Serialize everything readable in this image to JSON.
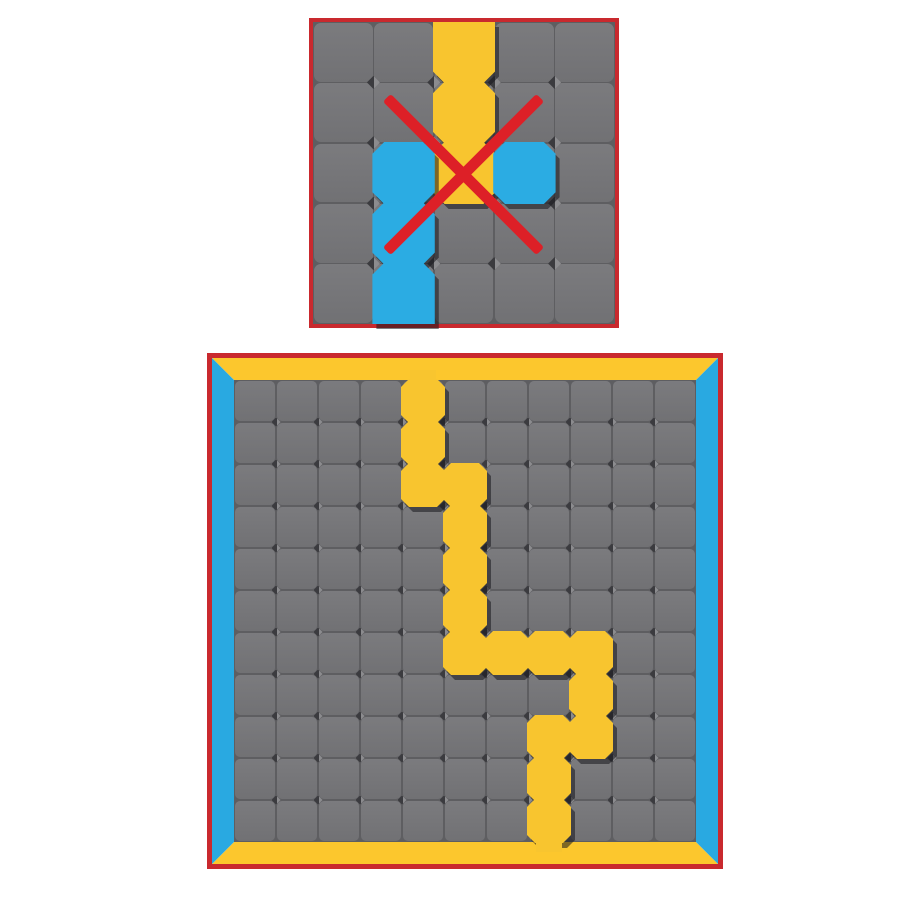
{
  "meta": {
    "width": 900,
    "height": 900,
    "background": "#ffffff"
  },
  "colors": {
    "board_border": "#C9292E",
    "cross": "#DD2027",
    "path_yellow": "#F8C52F",
    "path_blue": "#2BACE3",
    "frame_yellow": "#FCC72D",
    "frame_blue": "#29A9E1",
    "cell_fill_top": "#7B7B7E",
    "cell_fill_bottom": "#717174",
    "grid_line": "#5E5E61",
    "notch_dark": "#3B3B3F",
    "notch_light": "#8C8C8F",
    "shadow": "rgba(24,24,30,0.55)"
  },
  "tutorial_board": {
    "label": "invalid-move-example",
    "x": 309,
    "y": 18,
    "size": 310,
    "border": 4,
    "frame": 0,
    "cols": 5,
    "rows": 5,
    "interactable": false,
    "paths": [
      {
        "name": "yellow-path",
        "color_key": "path_yellow",
        "cells": [
          [
            2,
            0
          ],
          [
            2,
            1
          ],
          [
            2,
            2
          ]
        ],
        "flush": [
          {
            "col": 2,
            "row": 0,
            "side": "top"
          }
        ],
        "tabs": []
      },
      {
        "name": "blue-path",
        "color_key": "path_blue",
        "cells": [
          [
            1,
            2
          ],
          [
            3,
            2
          ],
          [
            1,
            3
          ],
          [
            1,
            4
          ]
        ],
        "flush": [
          {
            "col": 1,
            "row": 4,
            "side": "bottom"
          }
        ],
        "tabs": []
      }
    ],
    "cross": {
      "cx": 150,
      "cy": 152,
      "length": 217,
      "thickness": 11
    }
  },
  "main_board": {
    "label": "puzzle-board",
    "x": 207,
    "y": 353,
    "size": 516,
    "border": 5,
    "frame": 22,
    "cols": 11,
    "rows": 11,
    "interactable": true,
    "paths": [
      {
        "name": "yellow-path",
        "color_key": "path_yellow",
        "cells": [
          [
            4,
            0
          ],
          [
            4,
            1
          ],
          [
            4,
            2
          ],
          [
            5,
            2
          ],
          [
            5,
            3
          ],
          [
            5,
            4
          ],
          [
            5,
            5
          ],
          [
            5,
            6
          ],
          [
            6,
            6
          ],
          [
            7,
            6
          ],
          [
            8,
            6
          ],
          [
            8,
            7
          ],
          [
            8,
            8
          ],
          [
            7,
            8
          ],
          [
            7,
            9
          ],
          [
            7,
            10
          ]
        ],
        "flush": [],
        "tabs": [
          {
            "col": 4,
            "side": "top"
          },
          {
            "col": 7,
            "side": "bottom"
          }
        ]
      }
    ],
    "cross": null
  }
}
